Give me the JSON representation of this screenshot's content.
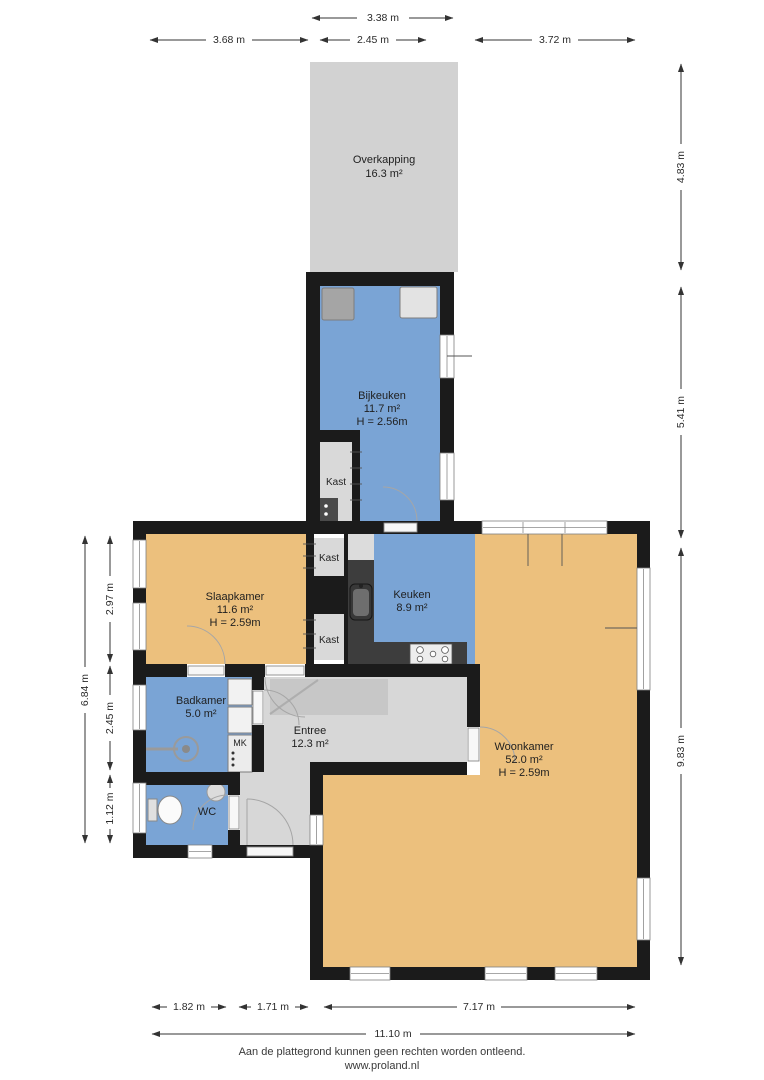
{
  "rooms": {
    "overkapping": {
      "name": "Overkapping",
      "area": "16.3 m²"
    },
    "bijkeuken": {
      "name": "Bijkeuken",
      "area": "11.7 m²",
      "height": "H = 2.56m"
    },
    "slaapkamer": {
      "name": "Slaapkamer",
      "area": "11.6 m²",
      "height": "H = 2.59m"
    },
    "keuken": {
      "name": "Keuken",
      "area": "8.9 m²"
    },
    "badkamer": {
      "name": "Badkamer",
      "area": "5.0 m²"
    },
    "entree": {
      "name": "Entree",
      "area": "12.3 m²"
    },
    "woonkamer": {
      "name": "Woonkamer",
      "area": "52.0 m²",
      "height": "H = 2.59m"
    },
    "wc": {
      "name": "WC"
    },
    "mk": {
      "name": "MK"
    },
    "kast": {
      "name": "Kast"
    }
  },
  "dims": {
    "top": [
      "3.38 m",
      "3.68 m",
      "2.45 m",
      "3.72 m"
    ],
    "right": [
      "4.83 m",
      "5.41 m",
      "9.83 m"
    ],
    "left": [
      "6.84 m",
      "2.97 m",
      "2.45 m",
      "1.12 m"
    ],
    "bottom": [
      "1.82 m",
      "1.71 m",
      "7.17 m",
      "11.10 m"
    ]
  },
  "footer": {
    "line1": "Aan de plattegrond kunnen geen rechten worden ontleend.",
    "line2": "www.proland.nl"
  },
  "colors": {
    "wall": "#1b1b1b",
    "room_blue": "#7aa4d5",
    "room_orange": "#ecc07d",
    "room_gray": "#d7d7d7",
    "overkapping_gray": "#d2d2d2",
    "stairs_gray": "#c7c7c7",
    "closet_gray": "#d9d9d9",
    "counter_dark": "#3d3d3d",
    "appliance_dark": "#a5a5a5",
    "appliance_light": "#e3e3e3"
  }
}
